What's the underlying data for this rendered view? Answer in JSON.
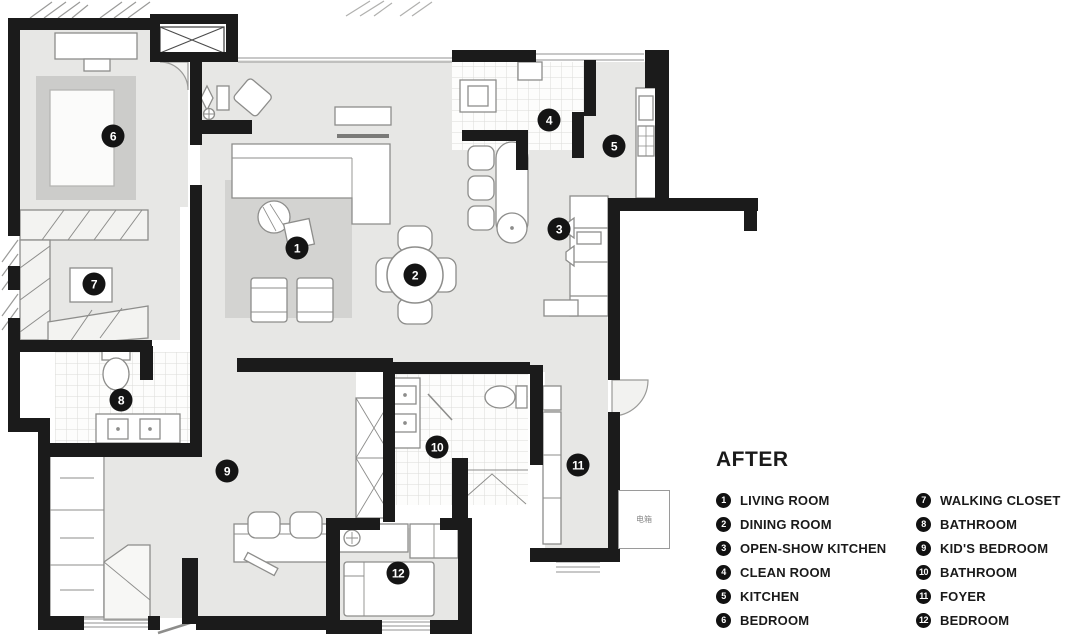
{
  "plan": {
    "electric_box_label": "电箱",
    "colors": {
      "wall": "#1b1b1b",
      "floor": "#e7e7e5",
      "rug": "#d3d3d1",
      "marker_bg": "#141414",
      "marker_text": "#ffffff"
    },
    "markers": [
      {
        "n": "1",
        "x": 297,
        "y": 248
      },
      {
        "n": "2",
        "x": 415,
        "y": 275
      },
      {
        "n": "3",
        "x": 559,
        "y": 229
      },
      {
        "n": "4",
        "x": 549,
        "y": 120
      },
      {
        "n": "5",
        "x": 614,
        "y": 146
      },
      {
        "n": "6",
        "x": 113,
        "y": 136
      },
      {
        "n": "7",
        "x": 94,
        "y": 284
      },
      {
        "n": "8",
        "x": 121,
        "y": 400
      },
      {
        "n": "9",
        "x": 227,
        "y": 471
      },
      {
        "n": "10",
        "x": 437,
        "y": 447
      },
      {
        "n": "11",
        "x": 578,
        "y": 465
      },
      {
        "n": "12",
        "x": 398,
        "y": 573
      }
    ]
  },
  "legend": {
    "title": "AFTER",
    "columns": [
      {
        "items": [
          {
            "n": "1",
            "label": "LIVING ROOM"
          },
          {
            "n": "2",
            "label": "DINING ROOM"
          },
          {
            "n": "3",
            "label": "OPEN-SHOW KITCHEN"
          },
          {
            "n": "4",
            "label": "CLEAN ROOM"
          },
          {
            "n": "5",
            "label": "KITCHEN"
          },
          {
            "n": "6",
            "label": "BEDROOM"
          }
        ]
      },
      {
        "items": [
          {
            "n": "7",
            "label": "WALKING CLOSET"
          },
          {
            "n": "8",
            "label": "BATHROOM"
          },
          {
            "n": "9",
            "label": "KID'S BEDROOM"
          },
          {
            "n": "10",
            "label": "BATHROOM"
          },
          {
            "n": "11",
            "label": "FOYER"
          },
          {
            "n": "12",
            "label": "BEDROOM"
          }
        ]
      }
    ]
  }
}
